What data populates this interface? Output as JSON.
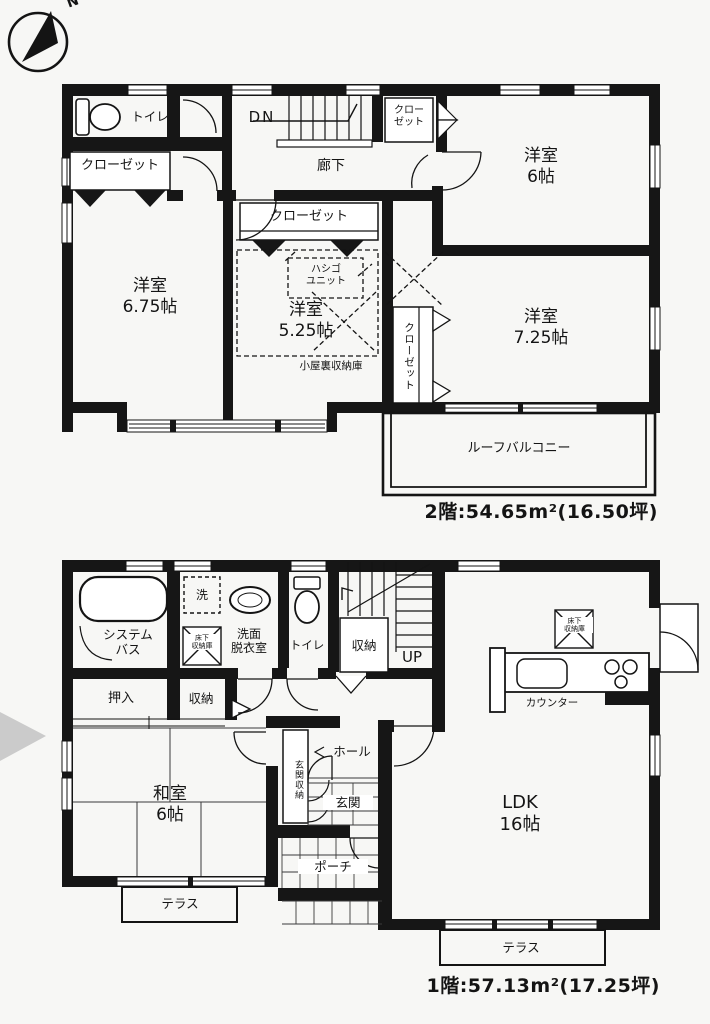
{
  "compass": {
    "north": "N"
  },
  "floor2": {
    "rooms": {
      "toilet": "トイレ",
      "closet_topleft": "クローゼット",
      "dn": "DN",
      "corridor": "廊下",
      "closet_top": "クロー\nゼット",
      "western6": "洋室\n6帖",
      "closet_center": "クローゼット",
      "ladder_unit": "ハシゴ\nユニット",
      "western675": "洋室\n6.75帖",
      "western525": "洋室\n5.25帖",
      "attic_storage": "小屋裏収納庫",
      "closet_vertical": "クローゼット",
      "western725": "洋室\n7.25帖",
      "roof_balcony": "ルーフバルコニー"
    },
    "area_label": "2階:54.65m²(16.50坪)"
  },
  "floor1": {
    "rooms": {
      "system_bath": "システム\nバス",
      "washer": "洗",
      "underfloor_storage_left": "床下\n収納庫",
      "washroom": "洗面\n脱衣室",
      "toilet": "トイレ",
      "storage_by_stairs": "収納",
      "up": "UP",
      "underfloor_storage_kitchen": "床下\n収納庫",
      "counter": "カウンター",
      "oshiire": "押入",
      "storage": "収納",
      "japanese_room": "和室\n6帖",
      "hall": "ホール",
      "entry_storage": "玄関収納",
      "entry": "玄関",
      "porch": "ポーチ",
      "terrace_left": "テラス",
      "ldk": "LDK\n16帖",
      "terrace_ldk": "テラス"
    },
    "area_label": "1階:57.13m²(17.25坪)"
  }
}
